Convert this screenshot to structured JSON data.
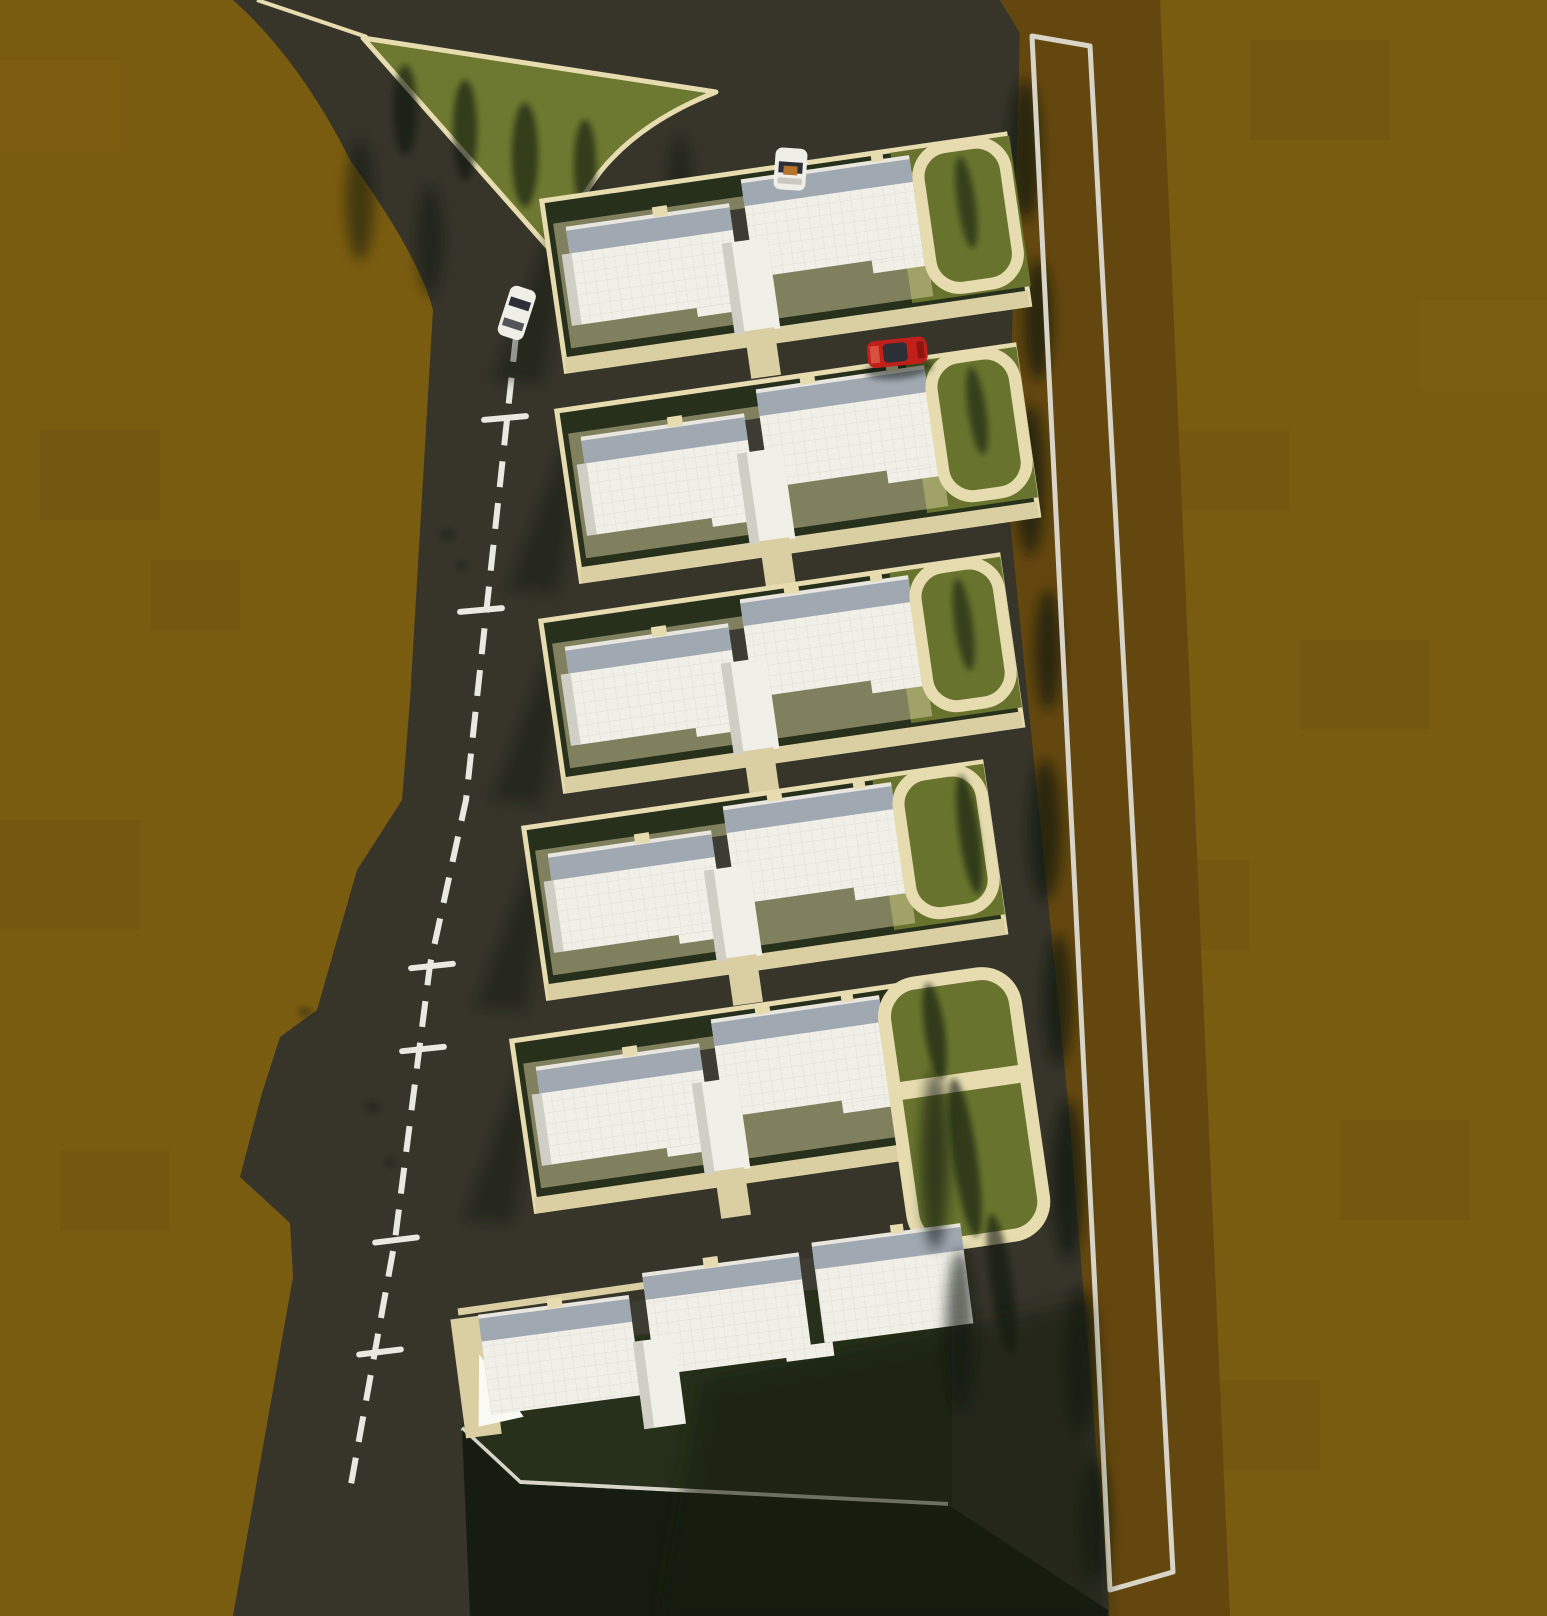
{
  "scene": {
    "label": "Aerial top-down 3D rendering of a residential site plan: six white duplex buildings in rows along a dark access road with a dashed center line, tan curbed parking loops with lawns, a triangular grass island with trees, a red car and two white cars, surrounded by brown terrain with a white surveyed boundary line on the right",
    "view": "top-down-render",
    "buildings_count": 6,
    "parking_loops_count": 5,
    "road_marking": "white dashed center line",
    "road_tick_count": 6,
    "cars": [
      {
        "name": "white-car-parked-top",
        "color": "#efefe8"
      },
      {
        "name": "white-car-roadside",
        "color": "#efefe8"
      },
      {
        "name": "red-car",
        "color": "#c01f1a"
      }
    ]
  },
  "palette": {
    "terrain": "#7a5c11",
    "terrain-dark": "#5f470e",
    "terrain-light": "#8a691a",
    "strip-brown": "#63470f",
    "road": "#37352a",
    "road-deep": "#2b2a21",
    "yard-green": "#26301b",
    "lawn-green": "#68742e",
    "island-green": "#6d7830",
    "deep-shadow": "#141a0e",
    "curb-tan": "#e6dcb0",
    "pad-tan": "#d9cfa2",
    "roof-white": "#f0efe8",
    "roof-gray": "#a0a8b2",
    "parapet": "#e8e6df",
    "slope-gray": "#cfcfc6",
    "wall-white": "#fafaf4",
    "line-white": "#d8d5c8",
    "dash-white": "#e9e9e1",
    "car-red": "#c01f1a",
    "car-white": "#efefe8",
    "glass-dark": "#2c2f35",
    "shadow": "#101208"
  }
}
